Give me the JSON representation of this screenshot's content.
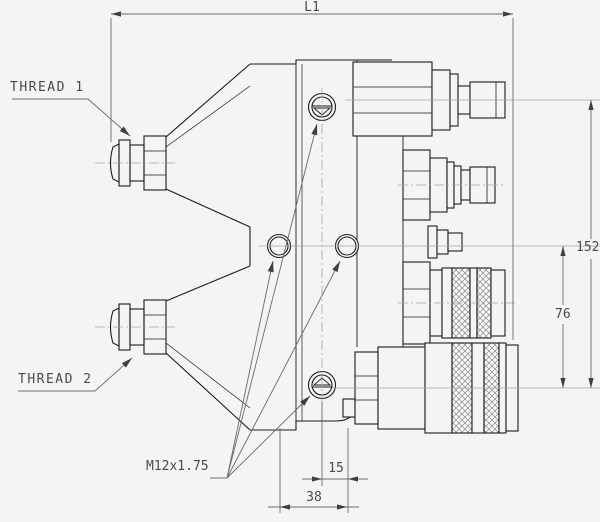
{
  "drawing": {
    "labels": {
      "thread1": "THREAD 1",
      "thread2": "THREAD 2",
      "m12": "M12x1.75"
    },
    "dimensions": {
      "l1": "L1",
      "d152": "152",
      "d76": "76",
      "d15": "15",
      "d38": "38"
    },
    "colors": {
      "background": "#f5f4f2",
      "part_line": "#1c1c1c",
      "dim_line": "#6b6b6b",
      "text": "#4a4a4a"
    }
  }
}
